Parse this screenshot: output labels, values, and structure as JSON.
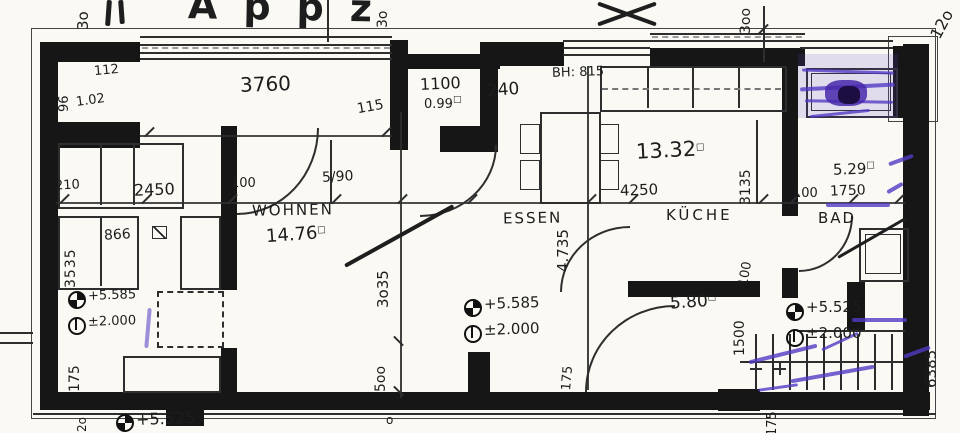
{
  "plan": {
    "title_fragment": "Appz",
    "unit_sup": "□",
    "rooms": {
      "wohnen": {
        "name": "WOHNEN",
        "area": "14.76"
      },
      "essen": {
        "name": "ESSEN"
      },
      "kueche": {
        "name": "KÜCHE",
        "area": "13.32"
      },
      "bad": {
        "name": "BAD",
        "area": "5.29"
      },
      "wc": {
        "area": "0.99"
      },
      "flur": {
        "area": "5.80"
      }
    },
    "dims": {
      "d3760": "3760",
      "d2450": "2450",
      "d100_wohnen": "100",
      "d590": "5/90",
      "d115": "115",
      "d1100": "1100",
      "d240": "240",
      "bh815": "BH: 815",
      "d4250": "4250",
      "d3135": "3135",
      "d4735": "4.735",
      "d3035": "3o35",
      "d500": "5oo",
      "d3535": "3535",
      "d866": "866",
      "d210": "210",
      "d96": "96",
      "d102": "1.02",
      "d112": "112",
      "d175_left": "175",
      "d175_flur": "175",
      "d175_stair": "175",
      "d1500": "1500",
      "d100_flur": "100",
      "d100_bad": "100",
      "d1750": "1750",
      "d6385": "6385",
      "d30_left": "3o",
      "d30_mid": "3o",
      "d300": "3oo",
      "d120": "12o",
      "d20": "2o",
      "o_mark": "o"
    },
    "levels": {
      "left_upper": "+5.585",
      "left_lower": "±2.000",
      "essen_upper": "+5.585",
      "essen_lower": "±2.000",
      "bad_upper": "+5.525",
      "bad_lower": "±2.000",
      "bottom": "+5.525"
    }
  }
}
